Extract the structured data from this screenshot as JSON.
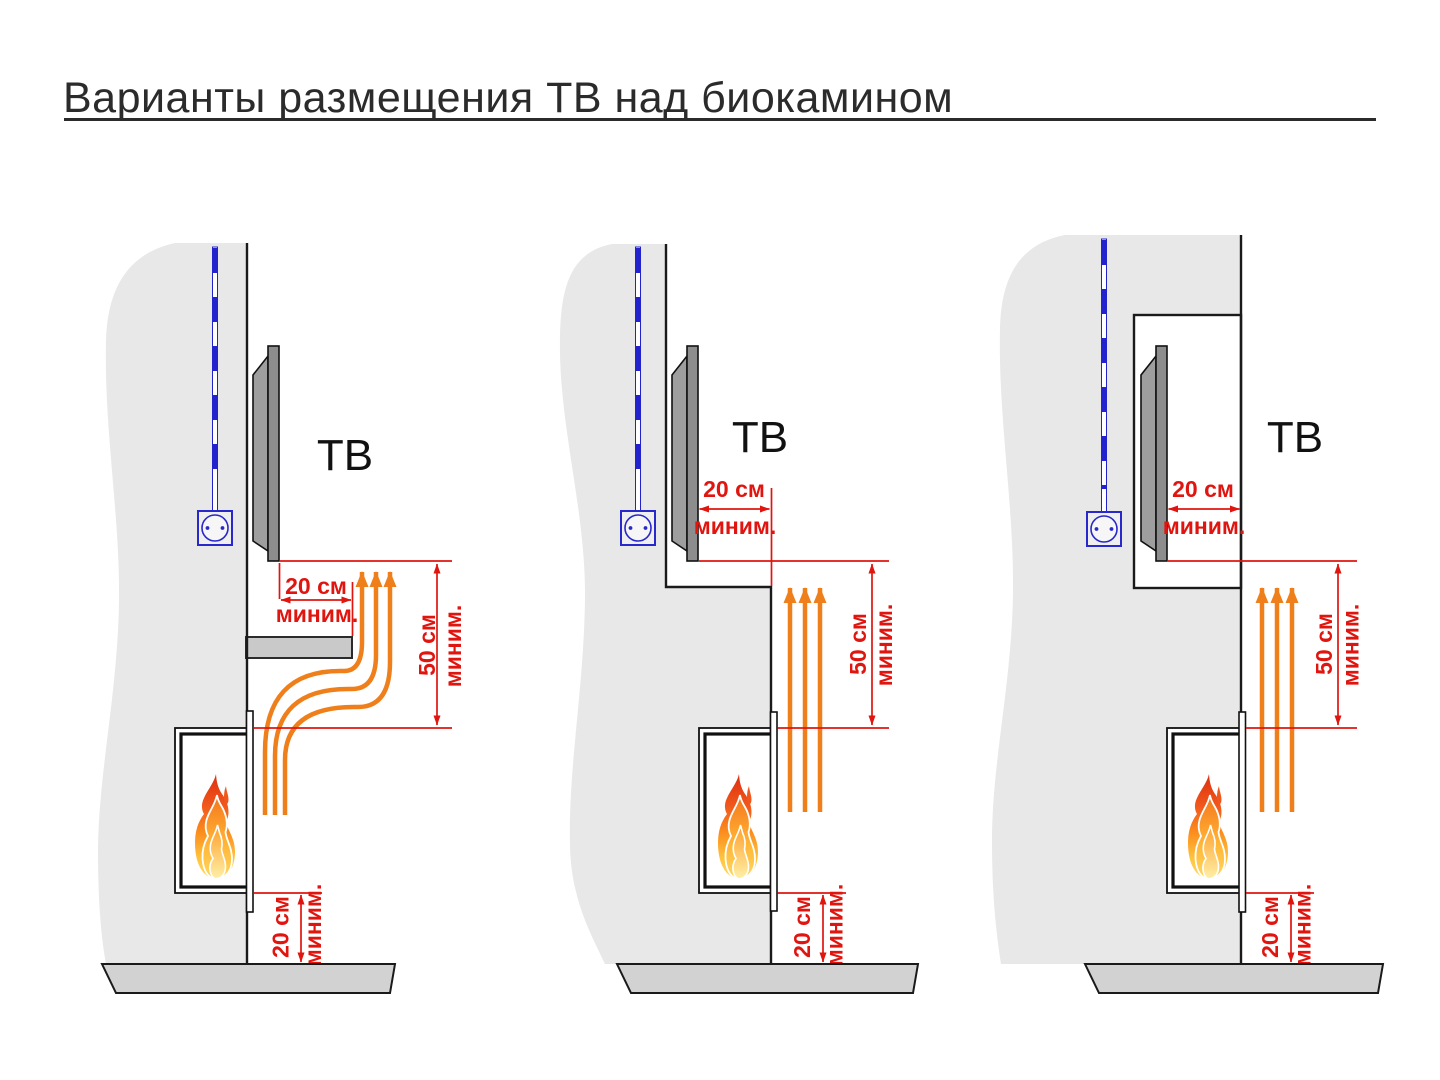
{
  "title": "Варианты размещения ТВ над биокамином",
  "colors": {
    "dimension_red": "#e0150f",
    "heat_orange": "#ef7f1a",
    "cable_blue": "#2323cd",
    "wall_gray": "#e8e8e8",
    "floor_gray": "#d2d2d2",
    "shelf_gray": "#c9c9c9",
    "tv_gray": "#8d8d8d",
    "outline_black": "#1a1a1a"
  },
  "diagrams": [
    {
      "tv_label": "ТВ",
      "side_clearance": {
        "value": "20 см",
        "qualifier": "миним."
      },
      "height_clearance": {
        "value": "50 см",
        "qualifier": "миним."
      },
      "floor_clearance": {
        "value": "20 см",
        "qualifier": "миним."
      }
    },
    {
      "tv_label": "ТВ",
      "side_clearance": {
        "value": "20 см",
        "qualifier": "миним."
      },
      "height_clearance": {
        "value": "50 см",
        "qualifier": "миним."
      },
      "floor_clearance": {
        "value": "20 см",
        "qualifier": "миним."
      }
    },
    {
      "tv_label": "ТВ",
      "side_clearance": {
        "value": "20 см",
        "qualifier": "миним."
      },
      "height_clearance": {
        "value": "50 см",
        "qualifier": "миним."
      },
      "floor_clearance": {
        "value": "20 см",
        "qualifier": "миним."
      }
    }
  ]
}
